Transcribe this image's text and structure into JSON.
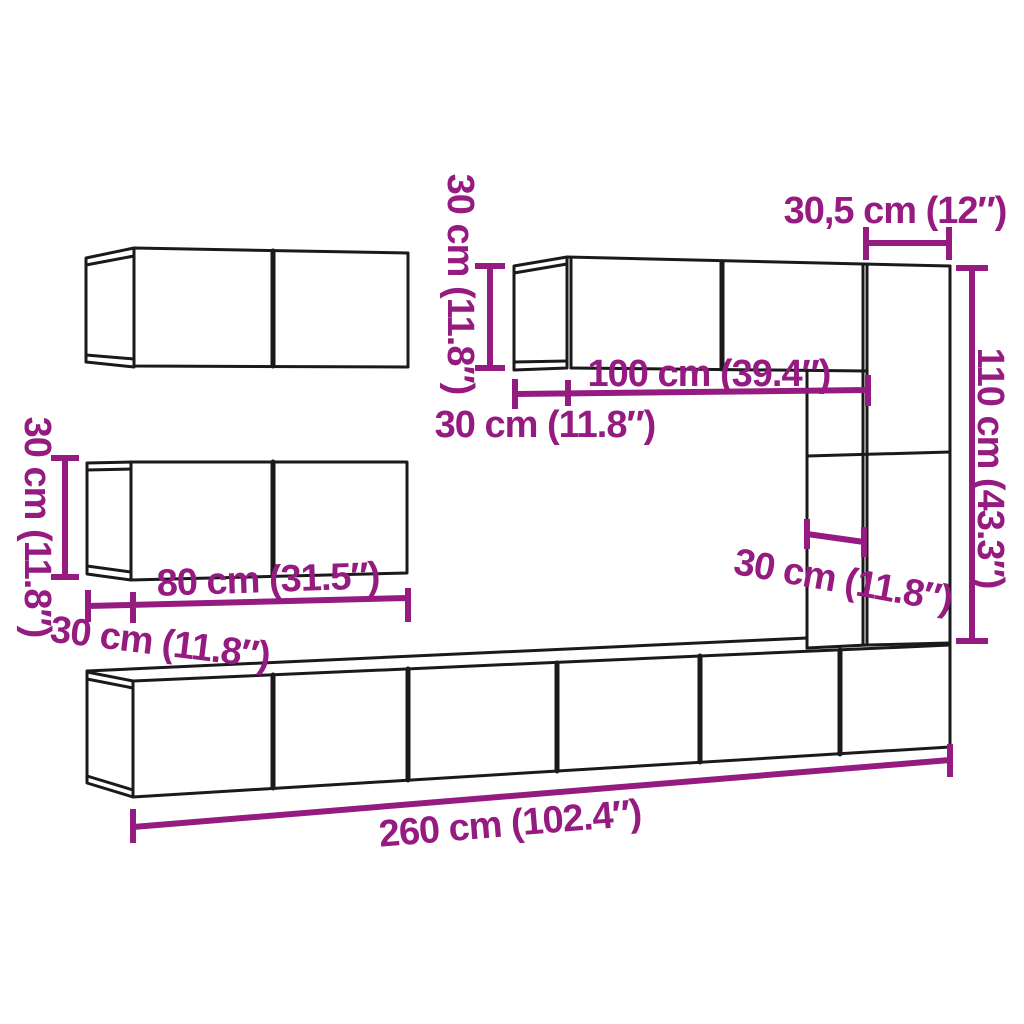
{
  "diagram": {
    "description": "Dimension diagram of a wall-mounted TV cabinet furniture set",
    "background_color": "#ffffff",
    "outline_color": "#1a1a1a",
    "dimension_color": "#951B81",
    "labels": {
      "upper_right_cabinet_height": "30 cm (11.8″)",
      "corner_cabinet_width": "30,5 cm (12″)",
      "upper_right_cabinet_width": "100 cm (39.4″)",
      "upper_right_cabinet_depth": "30 cm (11.8″)",
      "corner_cabinet_height": "110 cm (43.3″)",
      "corner_cabinet_depth": "30 cm (11.8″)",
      "left_cabinet_height": "30 cm (11.8″)",
      "left_cabinet_width": "80 cm (31.5″)",
      "left_cabinet_depth": "30 cm (11.8″)",
      "bottom_row_width": "260 cm (102.4″)"
    }
  }
}
